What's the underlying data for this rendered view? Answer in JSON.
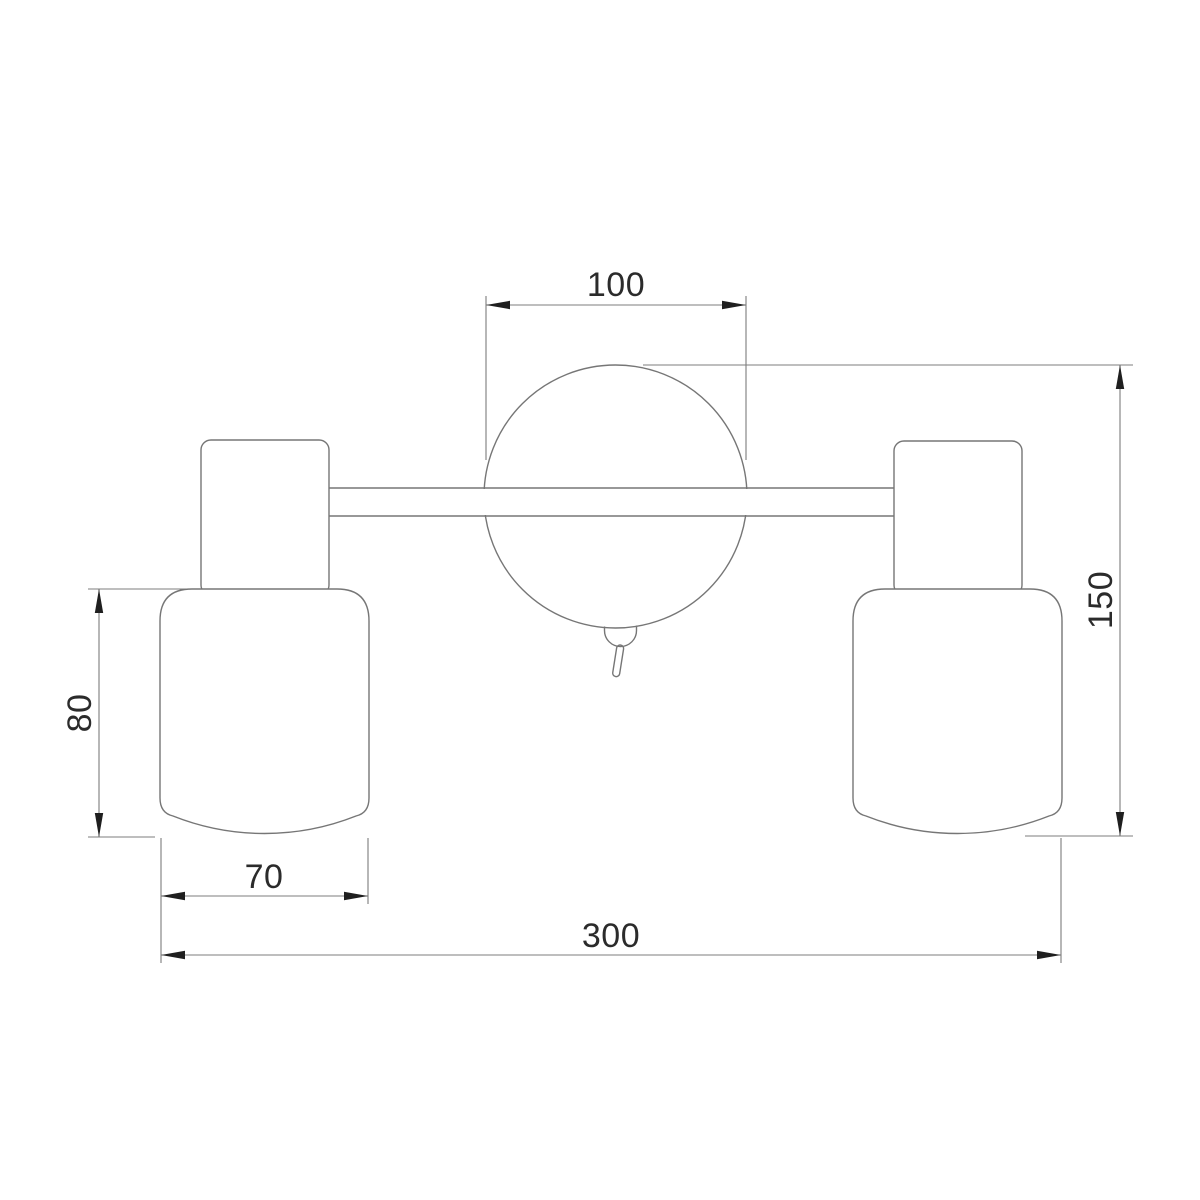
{
  "drawing": {
    "subject": "two-arm wall light fixture, front elevation",
    "view": "technical dimension drawing",
    "background_color": "#ffffff",
    "outline_color": "#767676",
    "dimension_line_color": "#7c7c7c",
    "arrow_color": "#1f1f1f",
    "text_color": "#2b2b2b",
    "dimensions": {
      "canopy_diameter": {
        "value": "100",
        "location": "top",
        "orientation": "horizontal"
      },
      "overall_height": {
        "value": "150",
        "location": "right",
        "orientation": "vertical-rotated"
      },
      "shade_height": {
        "value": "80",
        "location": "left",
        "orientation": "vertical-rotated"
      },
      "shade_width": {
        "value": "70",
        "location": "bottom-left",
        "orientation": "horizontal"
      },
      "overall_width": {
        "value": "300",
        "location": "bottom",
        "orientation": "horizontal"
      }
    }
  }
}
